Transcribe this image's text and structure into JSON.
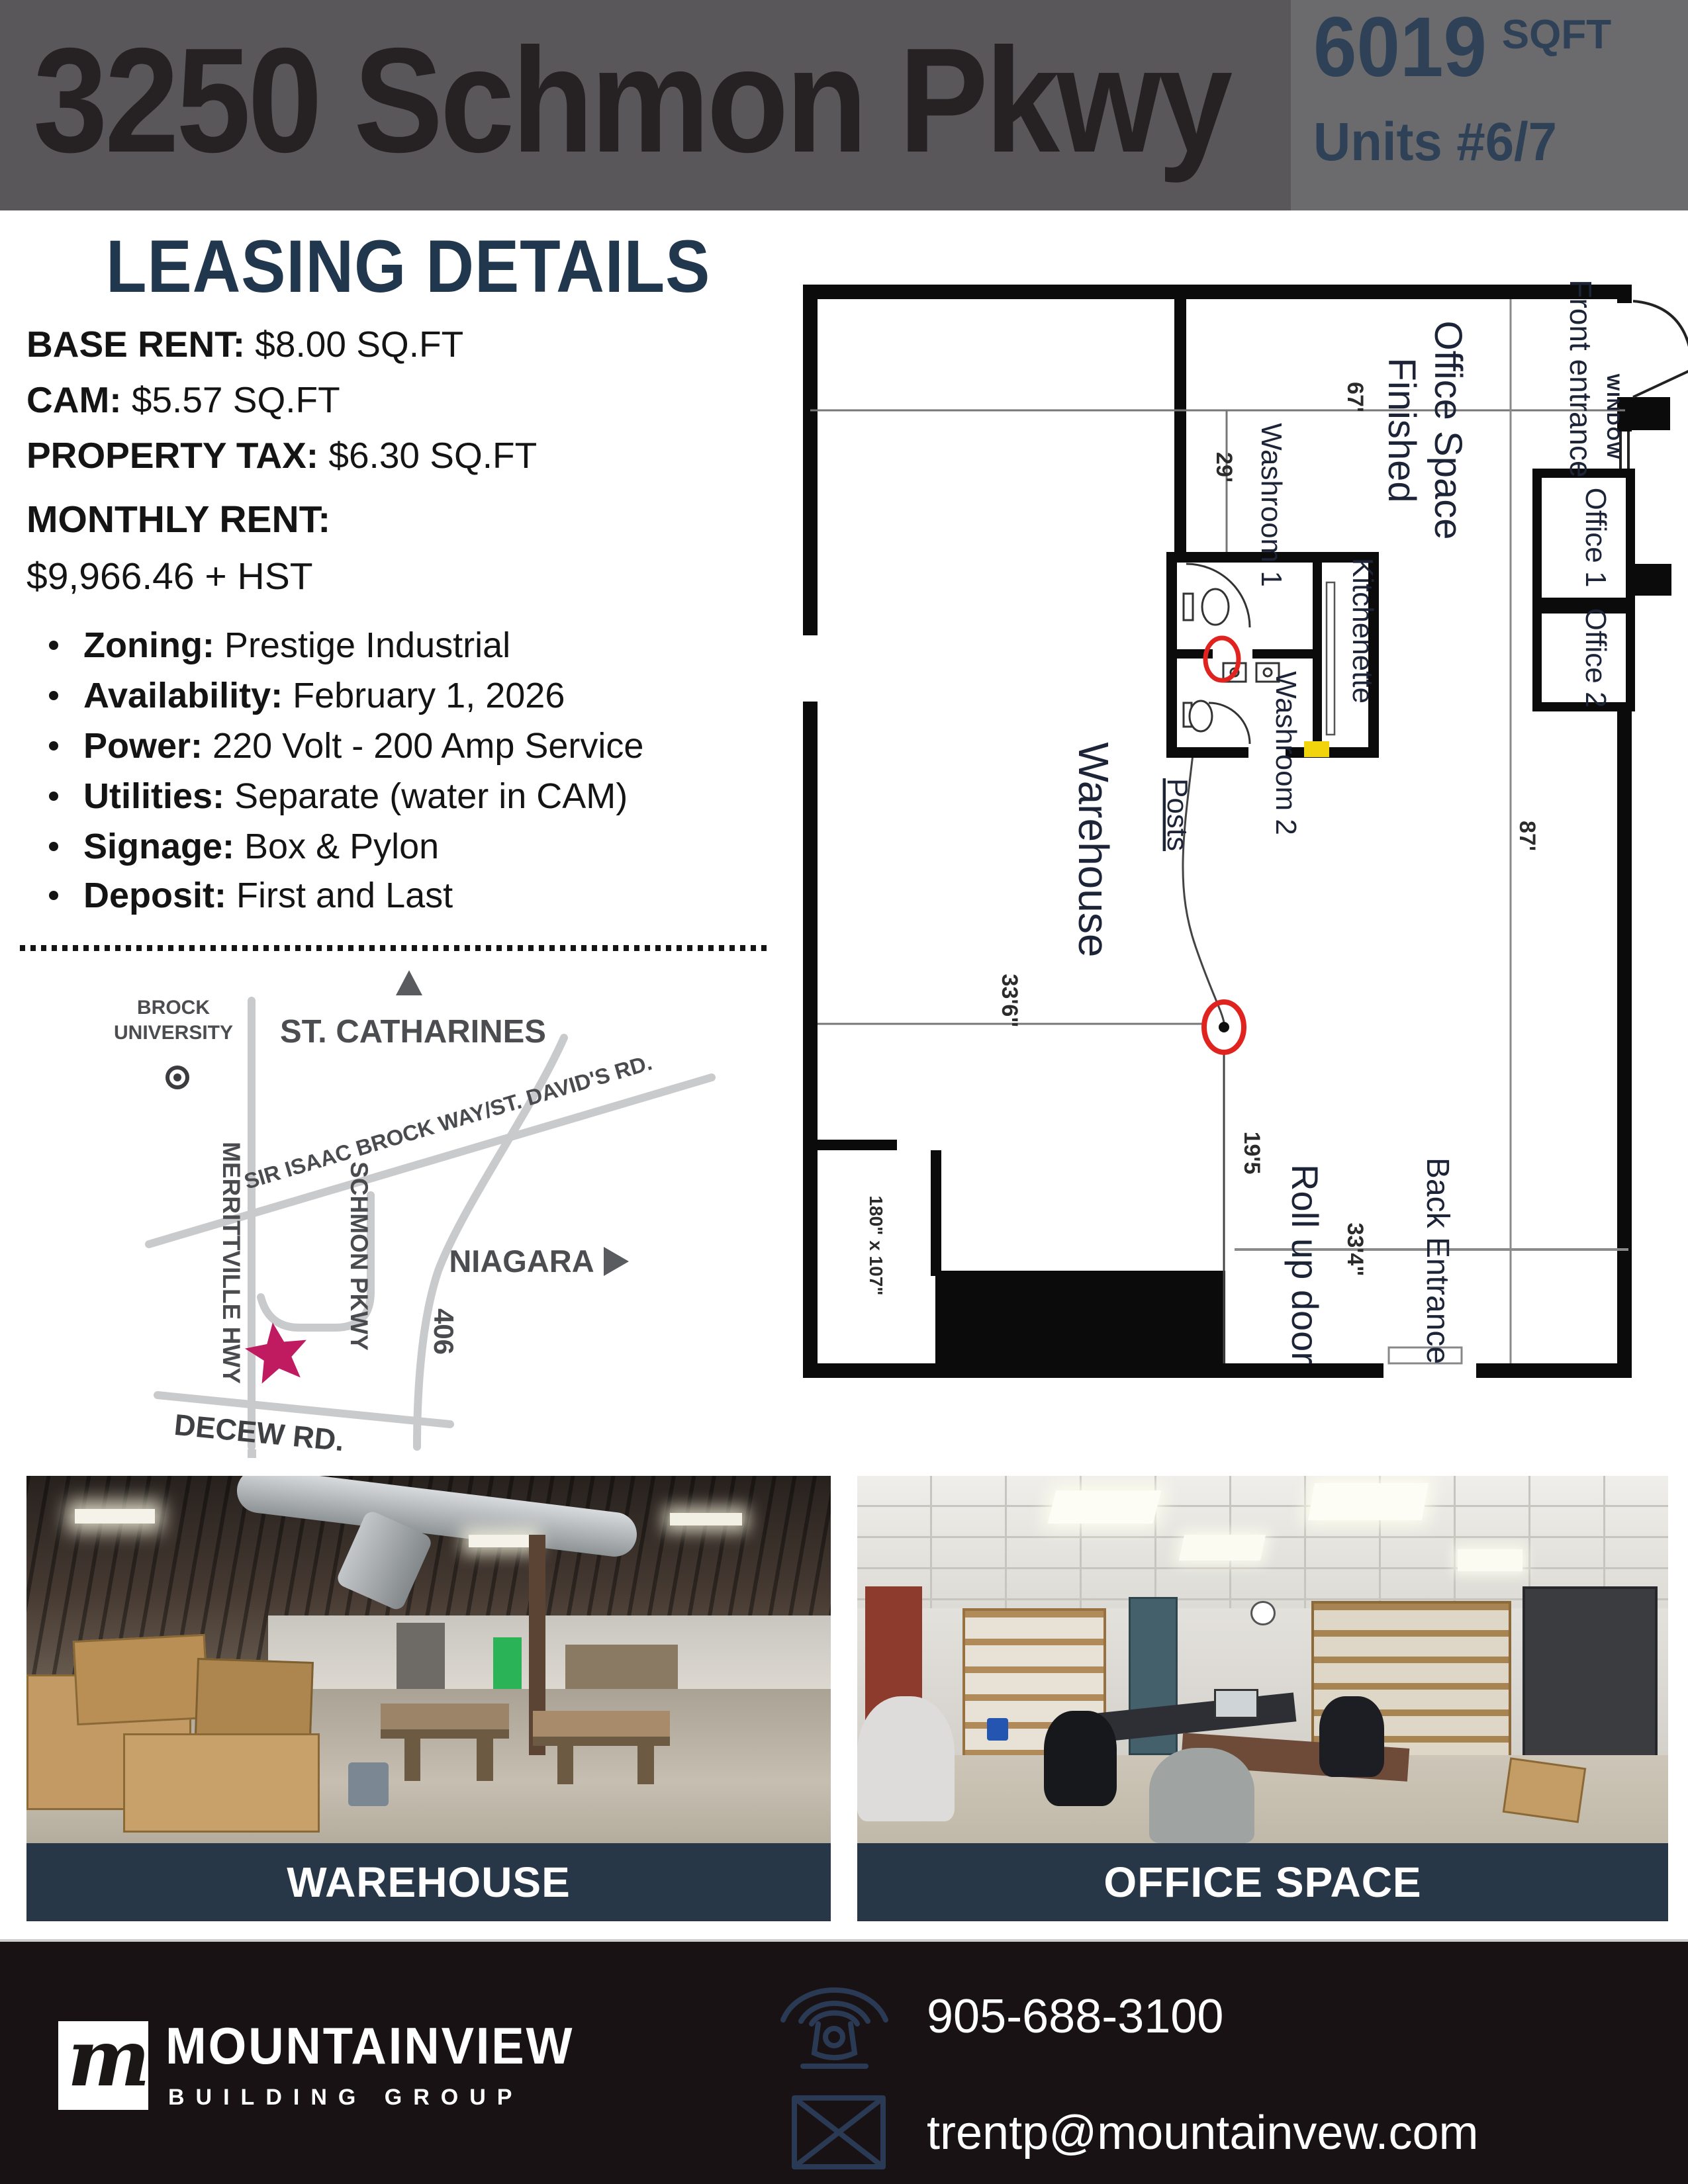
{
  "header": {
    "address": "3250 Schmon Pkwy",
    "sqft_value": "6019",
    "sqft_unit": "SQFT",
    "units": "Units #6/7"
  },
  "leasing": {
    "title": "LEASING DETAILS",
    "rates": [
      {
        "label": "BASE RENT:",
        "value": " $8.00 SQ.FT"
      },
      {
        "label": "CAM:",
        "value": " $5.57 SQ.FT"
      },
      {
        "label": "PROPERTY TAX:",
        "value": " $6.30 SQ.FT"
      }
    ],
    "monthly_label": "MONTHLY RENT:",
    "monthly_value": "$9,966.46 + HST",
    "features": [
      {
        "label": "Zoning:",
        "value": " Prestige Industrial"
      },
      {
        "label": "Availability:",
        "value": " February 1, 2026"
      },
      {
        "label": "Power:",
        "value": " 220 Volt - 200 Amp Service"
      },
      {
        "label": "Utilities:",
        "value": " Separate (water in CAM)"
      },
      {
        "label": "Signage:",
        "value": " Box & Pylon"
      },
      {
        "label": "Deposit:",
        "value": " First and Last"
      }
    ]
  },
  "map": {
    "city": "ST. CATHARINES",
    "university_line1": "BROCK",
    "university_line2": "UNIVERSITY",
    "road_diagonal": "SIR ISAAC BROCK WAY/ST. DAVID'S RD.",
    "road_vertical": "MERRITTVILLE HWY",
    "road_parkway": "SCHMON PKWY",
    "highway": "406",
    "direction": "NIAGARA",
    "road_bottom": "DECEW RD.",
    "star_color": "#c01b60"
  },
  "floorplan": {
    "finished_line1": "Finished",
    "finished_line2": "Office Space",
    "front_entrance": "Front entrance",
    "window": "WINDOW",
    "office1": "Office 1",
    "office2": "Office 2",
    "washroom1": "Washroom 1",
    "washroom2": "Washroom 2",
    "kitchenette": "Kitchenette",
    "warehouse": "Warehouse",
    "posts": "Posts",
    "roll_up_door": "Roll up door",
    "back_entrance": "Back Entrance",
    "dims": {
      "d67": "67'",
      "d29": "29'",
      "d87": "87'",
      "d33_6": "33'6\"",
      "d19_5": "19'5",
      "d33_4": "33'4\"",
      "d180": "180\" x 107\""
    }
  },
  "photos": {
    "warehouse_caption": "WAREHOUSE",
    "office_caption": "OFFICE SPACE"
  },
  "footer": {
    "logo_letter": "m",
    "brand": "MOUNTAINVIEW",
    "brand_sub": "BUILDING GROUP",
    "phone": "905-688-3100",
    "email": "trentp@mountainvew.com"
  },
  "colors": {
    "header_bg": "#59575a",
    "header_panel_bg": "#6b6b6e",
    "accent_navy": "#2e4156",
    "heading_navy": "#21374d",
    "caption_bg": "#273748",
    "footer_bg": "#181214",
    "road_gray": "#c9cacc",
    "map_text": "#4c4d51",
    "red_marker": "#e0231e",
    "highlight_yellow": "#f2d40c"
  }
}
